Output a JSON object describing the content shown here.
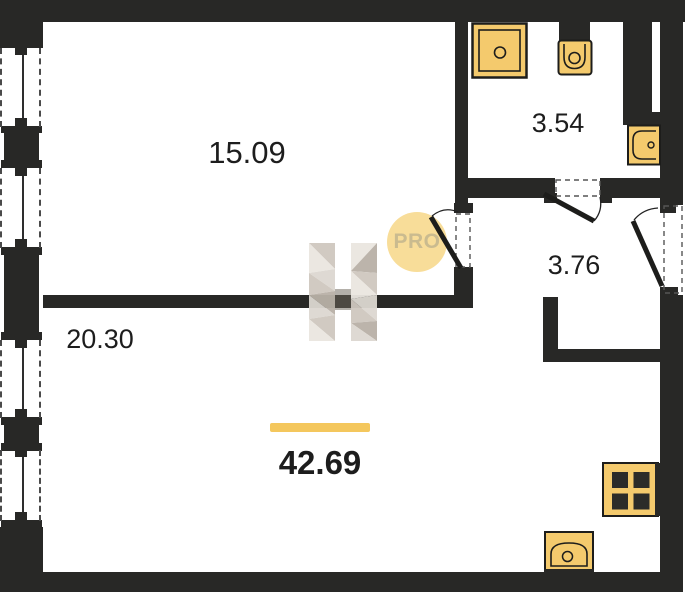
{
  "floor_plan": {
    "total_area_label": "42.69",
    "rooms": [
      {
        "id": "room-main",
        "area_label": "15.09"
      },
      {
        "id": "room-kitchen-living",
        "area_label": "20.30"
      },
      {
        "id": "bathroom",
        "area_label": "3.54"
      },
      {
        "id": "hallway",
        "area_label": "3.76"
      }
    ],
    "watermark": {
      "badge_text": "PRO",
      "logo_letter": "H"
    },
    "fixtures": [
      "shower",
      "toilet",
      "washbasin",
      "kitchen-sink",
      "cooktop"
    ],
    "colors": {
      "wall": "#282826",
      "fixture_fill": "#F4CA6D",
      "fixture_stroke": "#1d1d1b",
      "accent_gold": "#F4C75D",
      "badge_bg": "#F8DC96",
      "badge_text": "#C9B98C",
      "watermark_light": "#EAE6E0",
      "watermark_mid": "#CFC8BF",
      "watermark_dark": "#B9B1A7",
      "watermark_soft": "#DDD8D1",
      "text": "#1d1d1d",
      "dash": "#4a4a4a"
    }
  }
}
